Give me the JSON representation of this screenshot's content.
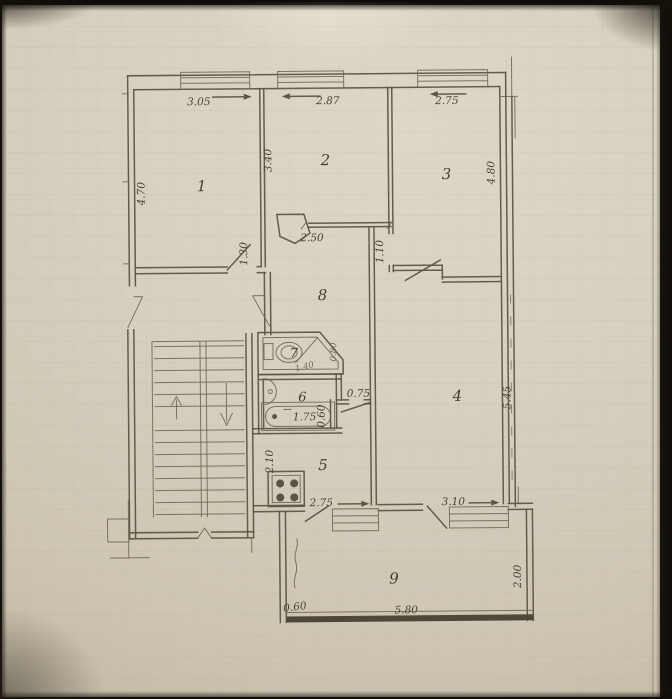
{
  "rooms": {
    "r1": "1",
    "r2": "2",
    "r3": "3",
    "r4": "4",
    "r5": "5",
    "r6": "6",
    "r7": "7",
    "r8": "8",
    "r9": "9"
  },
  "dimensions": {
    "room1_width": "3.05",
    "room2_width": "2.87",
    "room3_width": "2.75",
    "room1_depth": "4.70",
    "room2_depth": "3.40",
    "room3_depth": "4.80",
    "hall_width": "2.50",
    "room1_door": "1.30",
    "room3_door": "1.10",
    "corridor_door": "0.75",
    "bath_recess": "0.60",
    "bathtub_length": "1.75",
    "room4_depth": "5.45",
    "kitchen_side": "2.10",
    "kitchen_window_wall": "2.75",
    "room4_window_wall": "3.10",
    "balcony_end": "0.60",
    "balcony_length": "5.80",
    "balcony_depth": "2.00",
    "toilet_length": "1.40",
    "toilet_width": "0.80"
  },
  "icons": {
    "toilet": "toilet-icon",
    "sink": "sink-icon",
    "bathtub": "bathtub-icon",
    "stove": "stove-icon",
    "stairs_up": "stairs-up-arrow-icon",
    "stairs_down": "stairs-down-arrow-icon",
    "window": "window-symbol",
    "door": "door-swing"
  },
  "colors": {
    "paper": "#d6cfbe",
    "ink": "#5d5544",
    "photo_background": "#191510",
    "balcony_rail": "#4e4839",
    "label_ink": "#4a4233"
  }
}
